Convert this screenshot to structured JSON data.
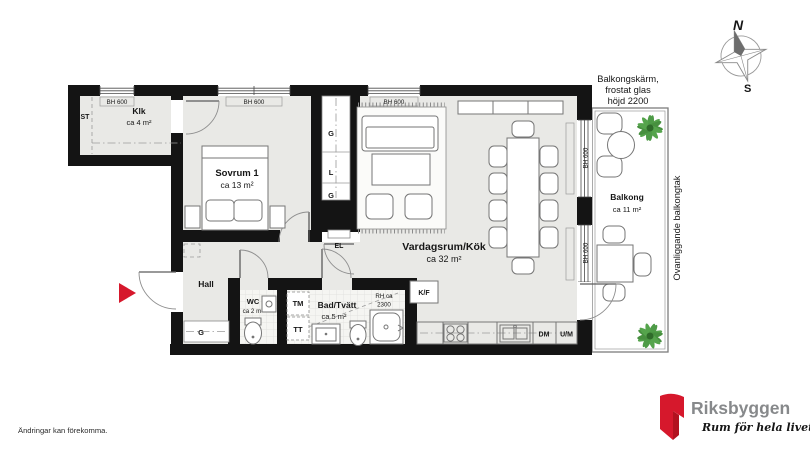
{
  "plan": {
    "rooms": {
      "klk": {
        "name": "Klk",
        "area": "ca 4 m²"
      },
      "sovrum1": {
        "name": "Sovrum 1",
        "area": "ca 13 m²"
      },
      "vardagsrum": {
        "name": "Vardagsrum/Kök",
        "area": "ca 32 m²"
      },
      "hall": {
        "name": "Hall"
      },
      "wc": {
        "name": "WC",
        "area": "ca 2 m²"
      },
      "bad": {
        "name": "Bad/Tvätt",
        "area": "ca 5 m²"
      },
      "balkong": {
        "name": "Balkong",
        "area": "ca 11 m²"
      }
    },
    "labels": {
      "st": "ST",
      "bh600": "BH 600",
      "g": "G",
      "l": "L",
      "el": "EL",
      "tm": "TM",
      "tt": "TT",
      "kf": "K/F",
      "dm": "DM",
      "um": "U/M",
      "rh1": "RH ca",
      "rh2": "2300"
    },
    "balcony_notes": {
      "screen1": "Balkongskärm,",
      "screen2": "frostat glas",
      "screen3": "höjd 2200",
      "roof": "Ovanliggande balkongtak"
    },
    "compass": {
      "north": "N",
      "south": "S"
    }
  },
  "footer": {
    "disclaimer": "Ändringar kan förekomma."
  },
  "logo": {
    "brand": "Riksbyggen",
    "tagline": "Rum för hela livet"
  },
  "colors": {
    "wall": "#141414",
    "floor": "#e9e9e6",
    "accent_red": "#d6182c",
    "plant_green": "#4e9b47",
    "logo_gray": "#87898b"
  }
}
